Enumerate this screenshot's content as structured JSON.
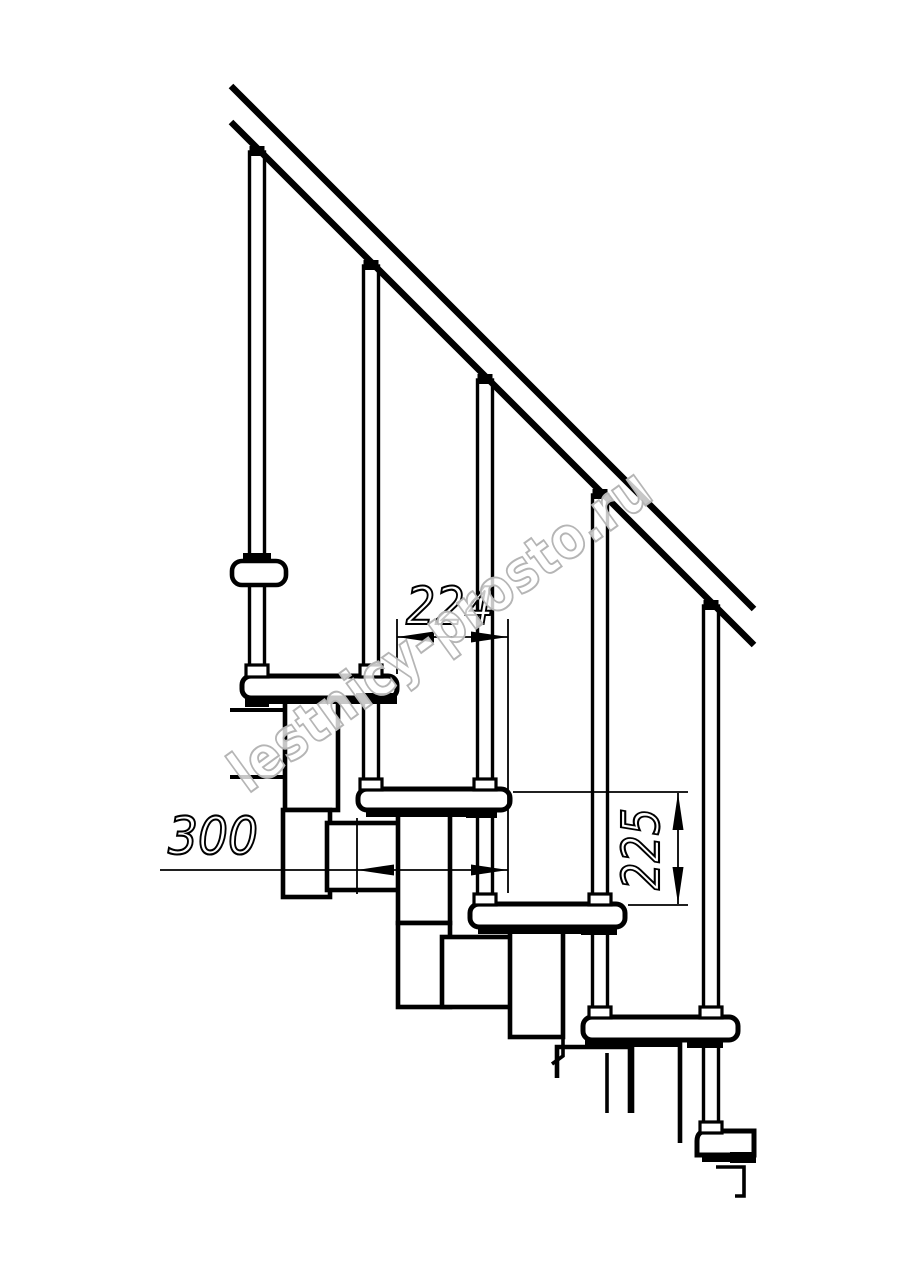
{
  "drawing": {
    "background_color": "#ffffff",
    "line_color": "#000000",
    "watermark": {
      "text": "lestnicy-prosto.ru",
      "color": "#b5b5b5"
    },
    "dimensions": {
      "going_between_noses": {
        "label": "224"
      },
      "tread_depth": {
        "label": "300"
      },
      "riser_height": {
        "label": "225"
      }
    },
    "structure": {
      "treads_visible": 5,
      "balusters_visible": 5,
      "handrail_angle_deg": 45
    }
  }
}
